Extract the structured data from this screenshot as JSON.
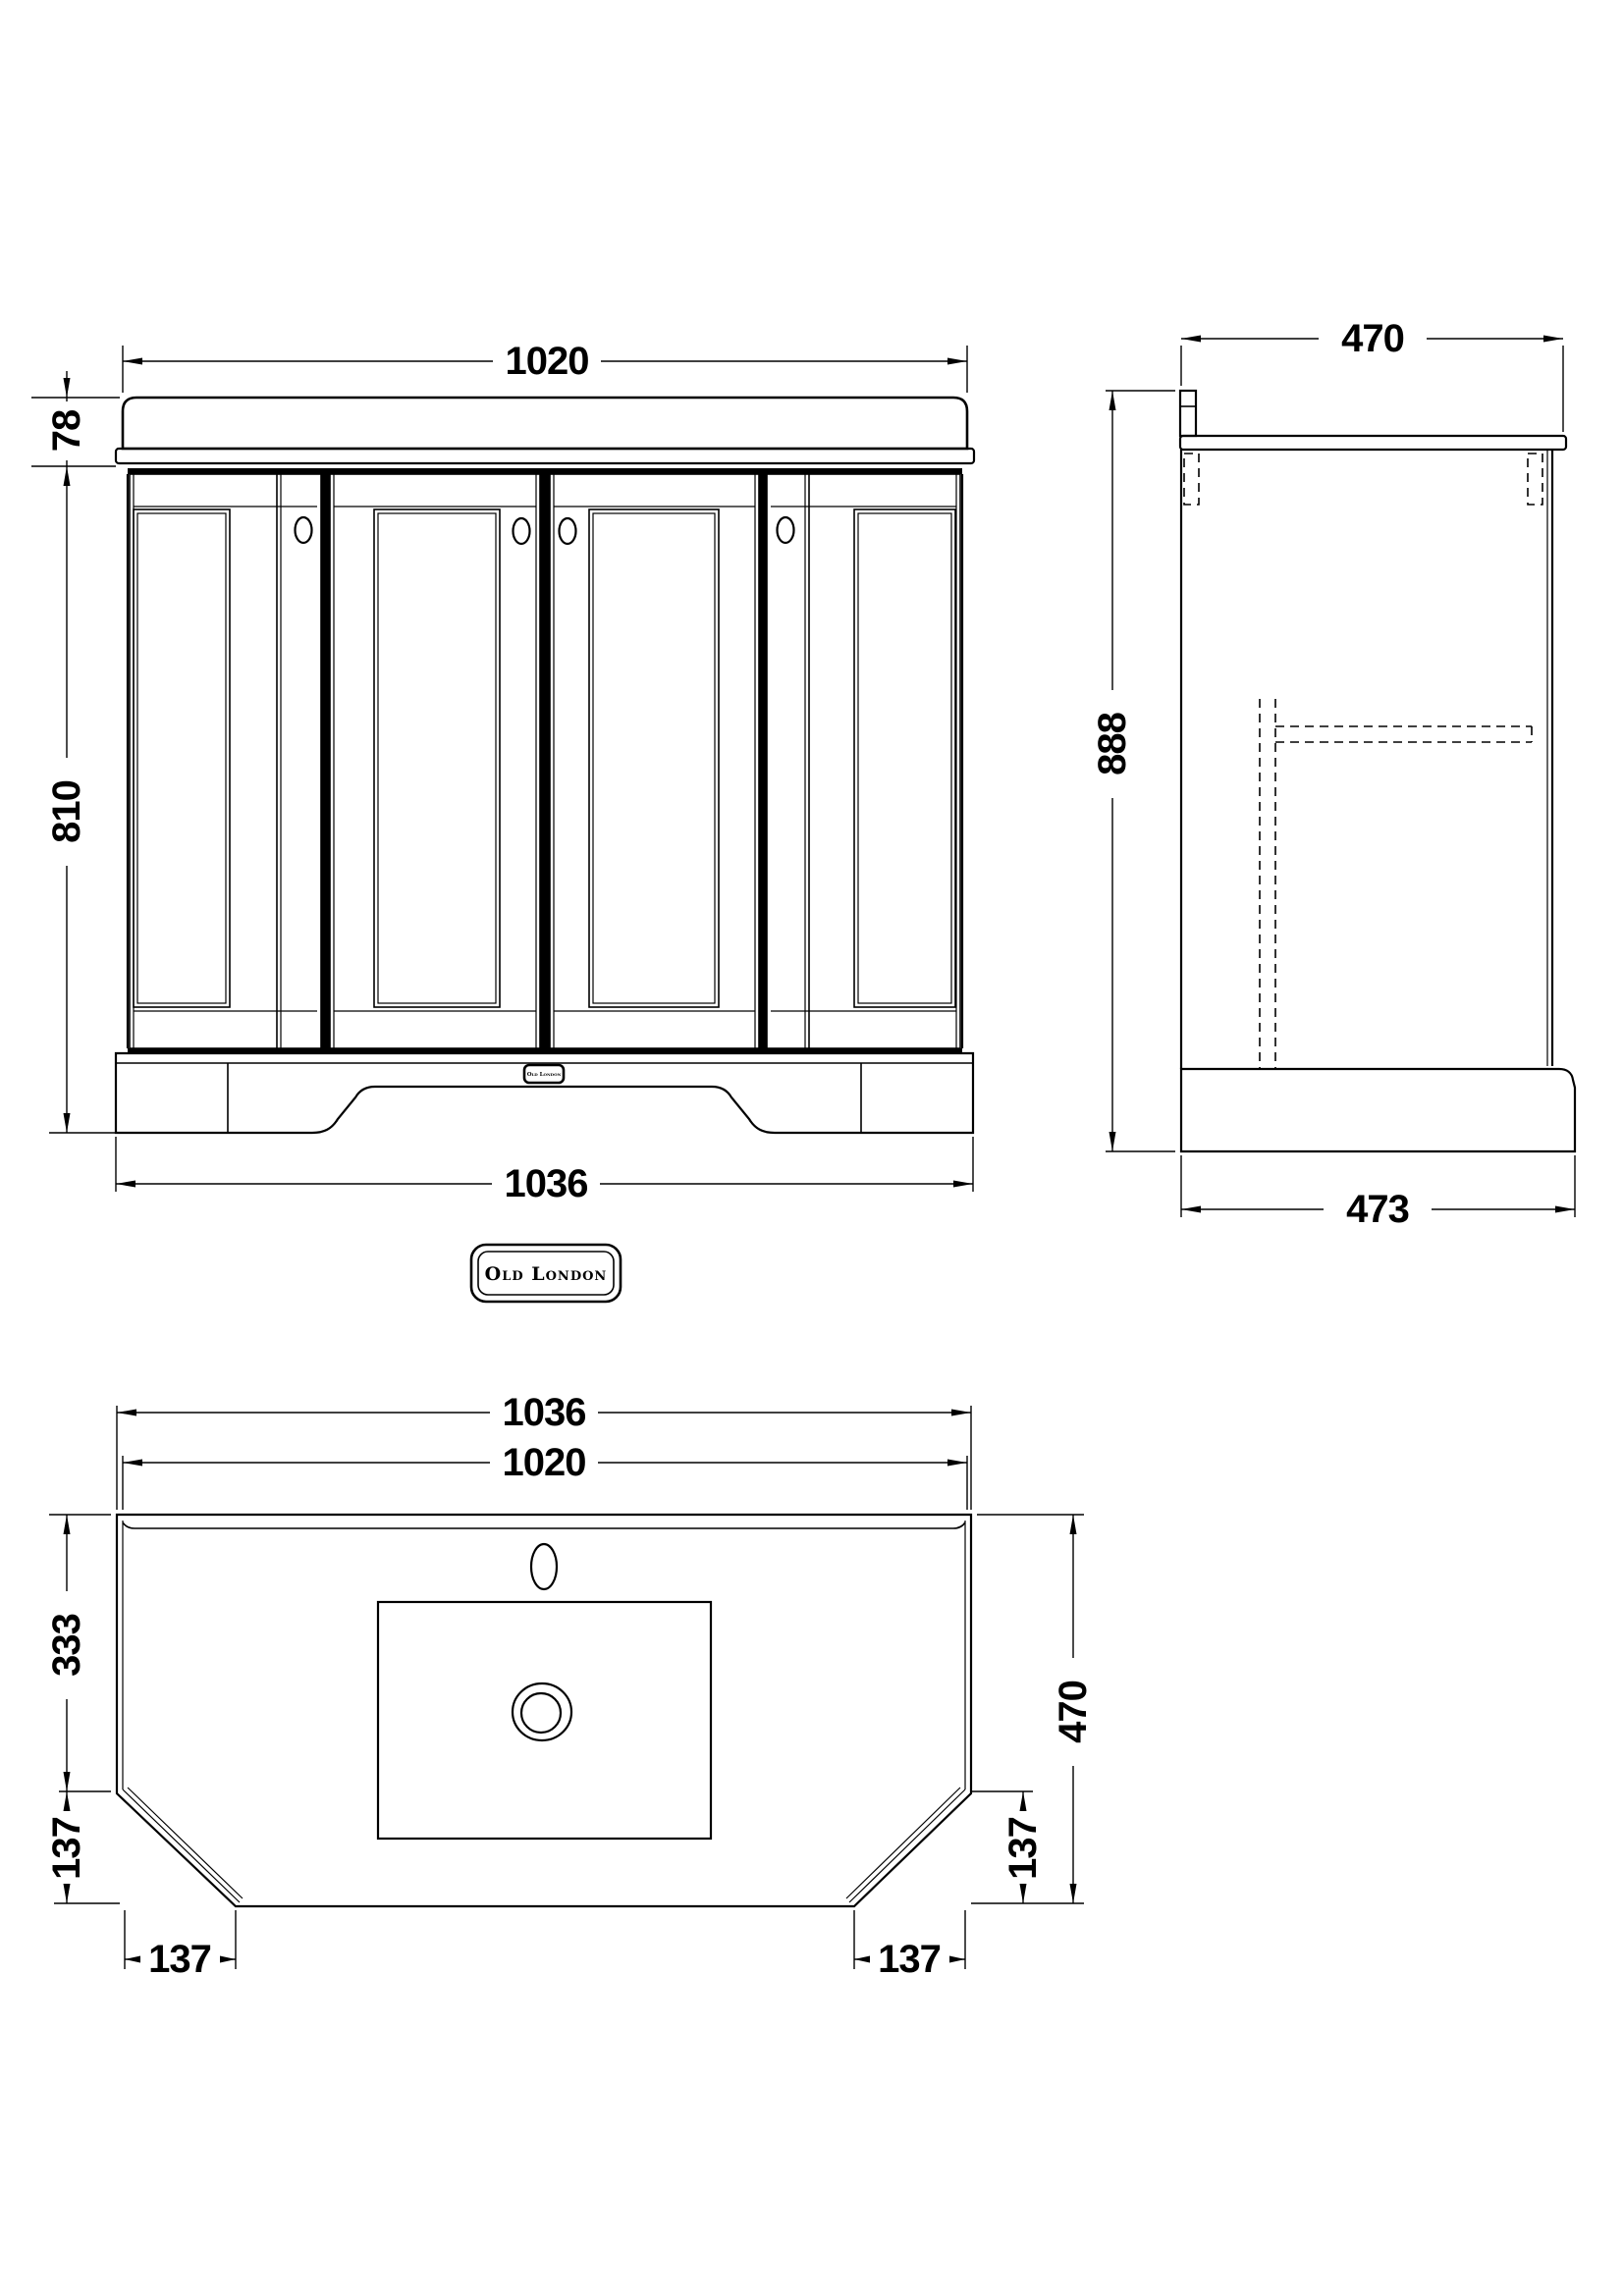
{
  "front": {
    "top_width": "1020",
    "worktop_height": "78",
    "cabinet_height": "810",
    "base_width": "1036",
    "badge": "Old London"
  },
  "side": {
    "top_depth": "470",
    "height": "888",
    "base_depth": "473"
  },
  "plan": {
    "outer_width": "1036",
    "inner_width": "1020",
    "back_section_depth": "333",
    "left_front_depth": "137",
    "right_front_depth": "137",
    "total_depth": "470",
    "left_chamfer_width": "137",
    "right_chamfer_width": "137"
  },
  "brand": {
    "name": "Old London"
  },
  "colors": {
    "line": "#000000",
    "background": "#ffffff"
  }
}
